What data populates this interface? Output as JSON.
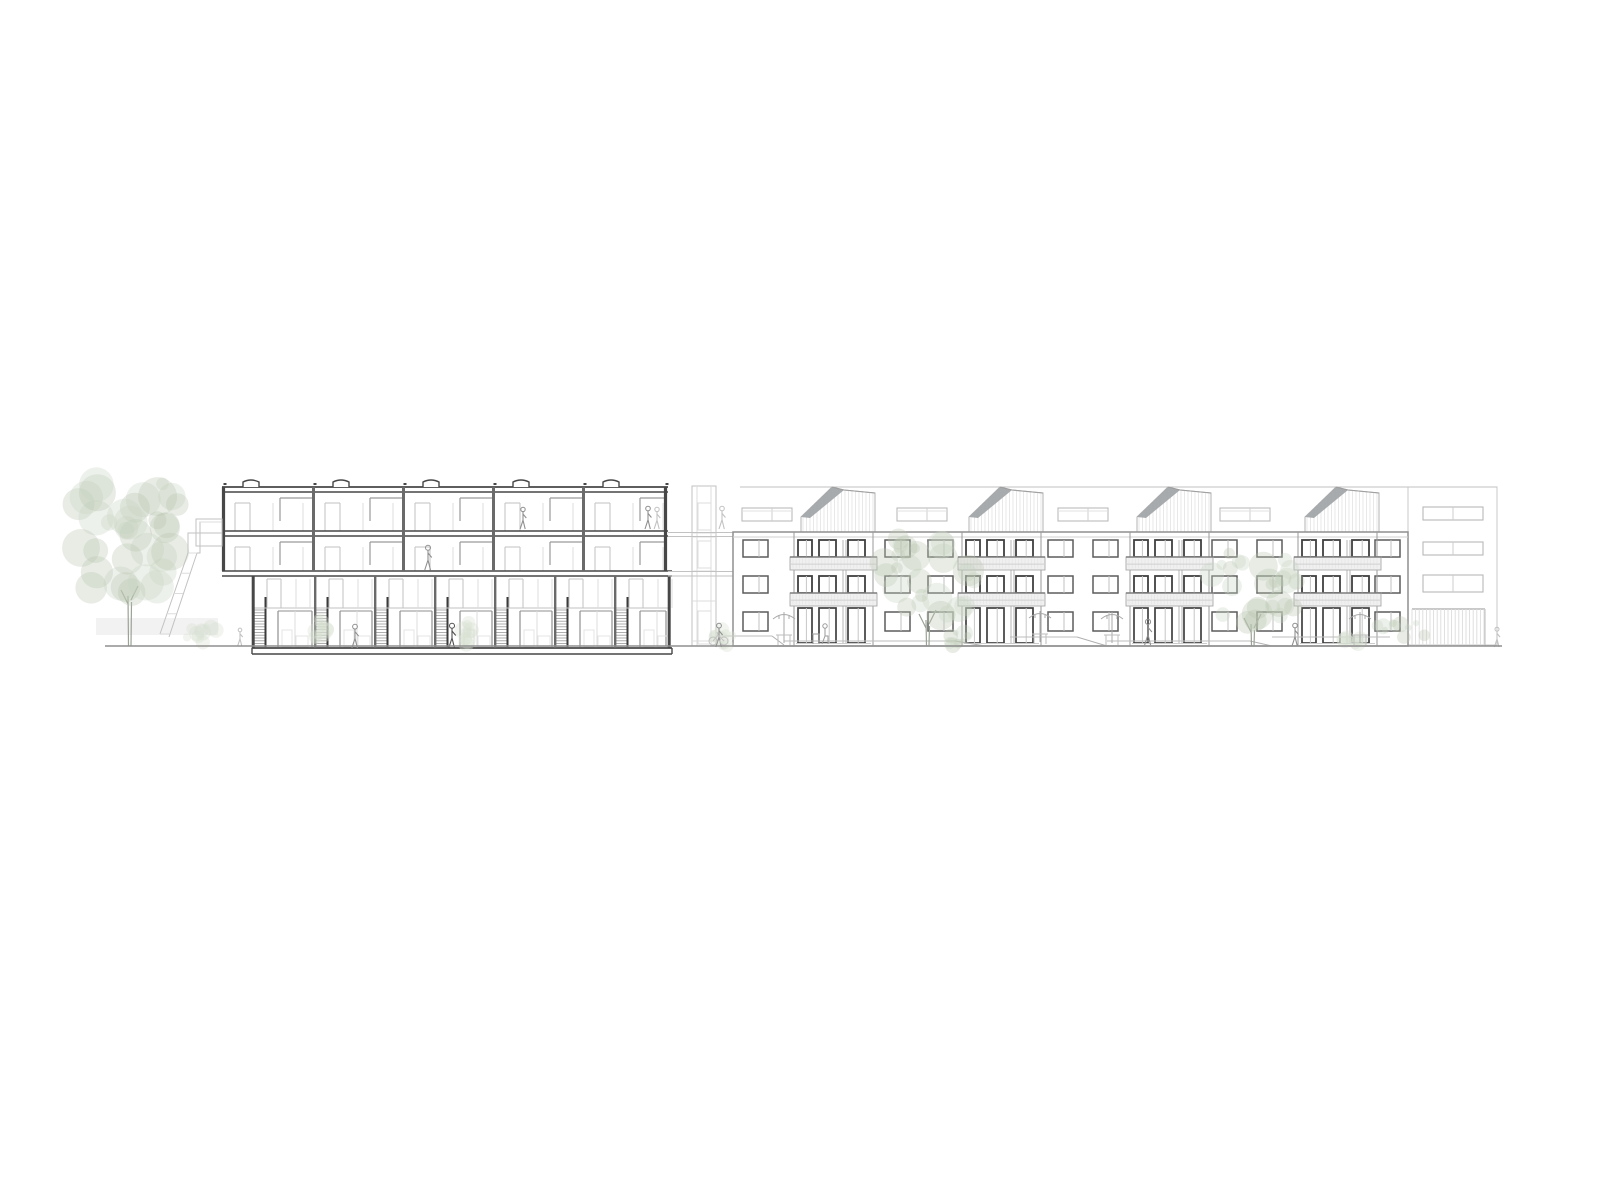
{
  "meta": {
    "drawing_type": "architectural-section-and-elevation",
    "canvas": {
      "w": 1600,
      "h": 1200
    },
    "background": "#ffffff"
  },
  "palette": {
    "section_ink": "#474747",
    "wall_ink": "#6a6a6a",
    "elev_ink": "#8f8f8f",
    "elev_dark": "#3f3f3f",
    "mid": "#9a9a9a",
    "faint": "#c2c2c2",
    "very_faint": "#dcdcdc",
    "ghost": "#e4e4e4",
    "panel_fill": "#f0f0f0",
    "panel_edge": "#a8a8a8",
    "panel_top": "#7d7d7d",
    "roof_gray": "#9fa4a6",
    "stripe": "#dcdcdc",
    "foliage1": "#c9d3c3",
    "foliage2": "#b9c6b1",
    "foliage_faint": "#d8dfd2",
    "trunk": "#9aa396",
    "figure": "#8f8f8f",
    "figure_dark": "#4f4f4f",
    "ground": "#8f8f8f"
  },
  "ground_line": {
    "x1": 105,
    "x2": 1502,
    "y": 646
  },
  "backdrop_band": {
    "x": 96,
    "y": 618,
    "w": 122,
    "h": 17
  },
  "section_building": {
    "upper": {
      "x1": 222,
      "x2": 668,
      "roof": [
        487,
        492
      ],
      "mid_slab": [
        531,
        536
      ],
      "bottom_slab": [
        571,
        576
      ],
      "walls": [
        222,
        312,
        402,
        492,
        582,
        664
      ],
      "floors": [
        {
          "ceil": 492,
          "floor": 531
        },
        {
          "ceil": 536,
          "floor": 571
        }
      ],
      "roof_bumps": [
        251,
        341,
        431,
        521,
        611
      ]
    },
    "lower": {
      "x1": 252,
      "x2": 672,
      "top": 576,
      "mezz_y": 608,
      "bottom_slab": [
        648,
        654
      ],
      "walls": [
        252,
        314,
        374,
        434,
        494,
        554,
        614,
        668
      ],
      "hatch": {
        "y1": 610,
        "y2": 647,
        "step": 2.8,
        "w": 11
      }
    },
    "overhang_balcony": {
      "x": 196,
      "y": 519,
      "w": 26,
      "h": 27
    }
  },
  "connector": {
    "x1": 692,
    "x2": 716,
    "top": 486,
    "bottom": 646,
    "inner": [
      697,
      711
    ],
    "levels": [
      533,
      537,
      571,
      576,
      601,
      641
    ],
    "doors": [
      {
        "y": 503,
        "h": 27
      },
      {
        "y": 541,
        "h": 27
      },
      {
        "y": 611,
        "h": 33
      }
    ],
    "bridge_y": [
      532.5,
      536.5,
      571.5,
      576
    ]
  },
  "elevation_building": {
    "facade": {
      "x1": 733,
      "x2": 1408,
      "top": 532,
      "bottom": 646,
      "string_y": 537
    },
    "roof_level_line": {
      "x1": 740,
      "x2": 1497,
      "y": 487
    },
    "penthouses": {
      "x": [
        801,
        969,
        1137,
        1305
      ],
      "w": 74,
      "peak_dx": 31,
      "peak2_dx": 43,
      "base_y": 532,
      "eave_y": 517,
      "peak_y": 487,
      "peak2_y": 490,
      "end_y": 493
    },
    "roof_bands": {
      "x": [
        742,
        897,
        1058,
        1220
      ],
      "w": 50,
      "y": 508,
      "h": 13
    },
    "wall_window_cols": [
      743,
      885,
      928,
      1048,
      1093,
      1212,
      1257,
      1375
    ],
    "wall_window": {
      "w": 25,
      "rows_y": [
        540,
        576
      ],
      "h": 17,
      "ground_y": 612,
      "ground_h": 19
    },
    "bays": {
      "x": [
        794,
        962,
        1130,
        1298
      ],
      "w": 79,
      "pier": [
        49,
        52
      ],
      "windows": [
        {
          "dx": 4,
          "w": 14
        },
        {
          "dx": 25,
          "w": 17
        },
        {
          "dx": 54,
          "w": 17
        }
      ],
      "rows_y": [
        540,
        576
      ],
      "win_h": 17,
      "balustrade": {
        "dx": -4,
        "w": 87,
        "rows_y": [
          557,
          593
        ],
        "h": 13
      },
      "doors_y": 608,
      "doors_h": 35
    },
    "wing": {
      "x1": 1408,
      "x2": 1497,
      "top": 487,
      "bottom": 645,
      "windows": {
        "x": 1423,
        "w": 60,
        "rows": [
          {
            "y": 507,
            "h": 13
          },
          {
            "y": 542,
            "h": 13
          },
          {
            "y": 575,
            "h": 17
          }
        ]
      },
      "striped_base": {
        "x1": 1412,
        "x2": 1485,
        "y1": 609,
        "y2": 646,
        "step": 3.6
      }
    },
    "path_segments": [
      {
        "x1": 718,
        "y": 636,
        "x2": 772
      },
      {
        "x1": 784,
        "y": 641,
        "x2": 955
      },
      {
        "x1": 1010,
        "y": 637,
        "x2": 1077
      },
      {
        "x1": 1107,
        "y": 641,
        "x2": 1250
      },
      {
        "x1": 1272,
        "y": 637,
        "x2": 1390
      }
    ],
    "path_ramps": [
      {
        "x1": 772,
        "y1": 636,
        "x2": 784,
        "y2": 645
      },
      {
        "x1": 955,
        "y1": 641,
        "x2": 985,
        "y2": 646
      },
      {
        "x1": 1077,
        "y1": 637,
        "x2": 1107,
        "y2": 646
      },
      {
        "x1": 1250,
        "y1": 641,
        "x2": 1272,
        "y2": 646
      }
    ]
  },
  "terrace_steps": {
    "rects": [
      {
        "x": 200,
        "y": 522,
        "w": 22,
        "h": 11
      },
      {
        "x": 188,
        "y": 533,
        "w": 12,
        "h": 20
      }
    ],
    "rails": [
      {
        "x1": 188,
        "y1": 553,
        "x2": 160,
        "y2": 634
      },
      {
        "x1": 197,
        "y1": 553,
        "x2": 169,
        "y2": 637
      }
    ],
    "treads": 5
  },
  "trees": [
    {
      "cx": 130,
      "cy": 540,
      "rx": 62,
      "ry": 66,
      "trunk_top": 596,
      "blobs": 34,
      "seed": 7,
      "scale": 1.25,
      "faint": false
    },
    {
      "cx": 928,
      "cy": 577,
      "rx": 47,
      "ry": 50,
      "trunk_top": 620,
      "blobs": 26,
      "seed": 13,
      "scale": 1.0,
      "faint": false
    },
    {
      "cx": 1253,
      "cy": 588,
      "rx": 46,
      "ry": 44,
      "trunk_top": 624,
      "blobs": 26,
      "seed": 29,
      "scale": 1.0,
      "faint": false
    }
  ],
  "bushes": [
    {
      "cx": 205,
      "cy": 634,
      "rx": 22,
      "ry": 11,
      "seed": 3,
      "faint": true
    },
    {
      "cx": 724,
      "cy": 637,
      "rx": 11,
      "ry": 9,
      "seed": 5,
      "faint": true
    },
    {
      "cx": 320,
      "cy": 630,
      "rx": 10,
      "ry": 16,
      "seed": 11,
      "faint": true
    },
    {
      "cx": 466,
      "cy": 633,
      "rx": 8,
      "ry": 13,
      "seed": 17,
      "faint": true
    },
    {
      "cx": 958,
      "cy": 639,
      "rx": 12,
      "ry": 7,
      "seed": 19,
      "faint": false
    },
    {
      "cx": 1402,
      "cy": 632,
      "rx": 28,
      "ry": 14,
      "seed": 23,
      "faint": false
    },
    {
      "cx": 1352,
      "cy": 641,
      "rx": 10,
      "ry": 5,
      "seed": 31,
      "faint": true
    }
  ],
  "figures": [
    {
      "x": 428,
      "y": 545,
      "h": 25,
      "tone": "figure"
    },
    {
      "x": 523,
      "y": 507,
      "h": 22,
      "tone": "figure"
    },
    {
      "x": 648,
      "y": 506,
      "h": 23,
      "tone": "figure"
    },
    {
      "x": 657,
      "y": 507,
      "h": 22,
      "tone": "faint"
    },
    {
      "x": 355,
      "y": 624,
      "h": 24,
      "tone": "figure"
    },
    {
      "x": 452,
      "y": 623,
      "h": 25,
      "tone": "figure_dark"
    },
    {
      "x": 240,
      "y": 628,
      "h": 18,
      "tone": "faint"
    },
    {
      "x": 722,
      "y": 506,
      "h": 23,
      "tone": "faint"
    },
    {
      "x": 719,
      "y": 623,
      "h": 24,
      "tone": "figure"
    },
    {
      "x": 1148,
      "y": 619,
      "h": 26,
      "tone": "figure"
    },
    {
      "x": 1295,
      "y": 623,
      "h": 23,
      "tone": "figure"
    },
    {
      "x": 1497,
      "y": 627,
      "h": 20,
      "tone": "faint"
    }
  ],
  "bike": {
    "x": 713,
    "y": 641
  },
  "umbrellas": [
    {
      "x": 784,
      "y": 615
    },
    {
      "x": 1040,
      "y": 614
    },
    {
      "x": 1112,
      "y": 615
    },
    {
      "x": 1360,
      "y": 615
    }
  ],
  "terrace_table": {
    "x": 818,
    "y": 629
  }
}
